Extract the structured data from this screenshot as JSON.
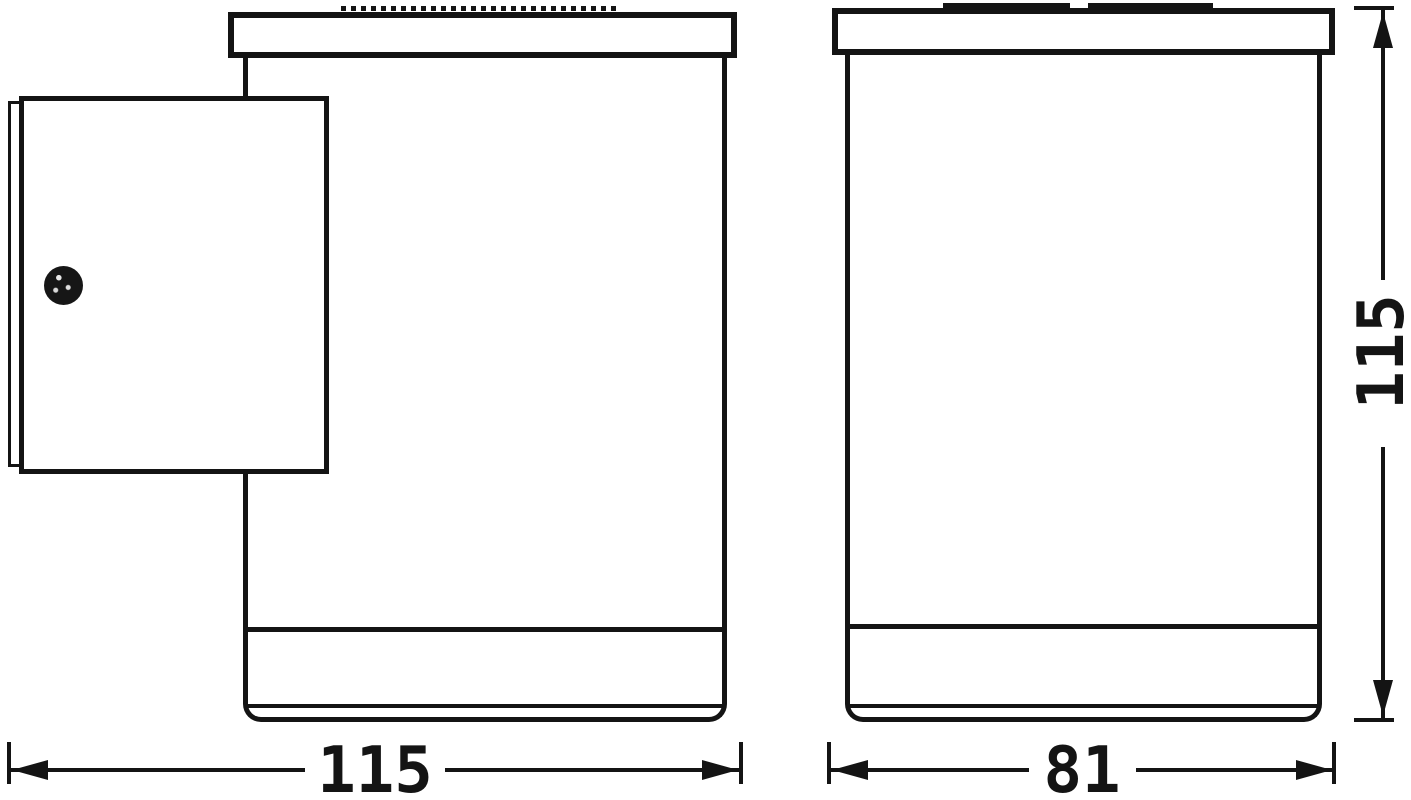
{
  "diagram": {
    "background_color": "#ffffff",
    "line_color": "#141414",
    "dimensions": {
      "depth": {
        "label": "115"
      },
      "width": {
        "label": "81"
      },
      "height": {
        "label": "115"
      }
    }
  }
}
